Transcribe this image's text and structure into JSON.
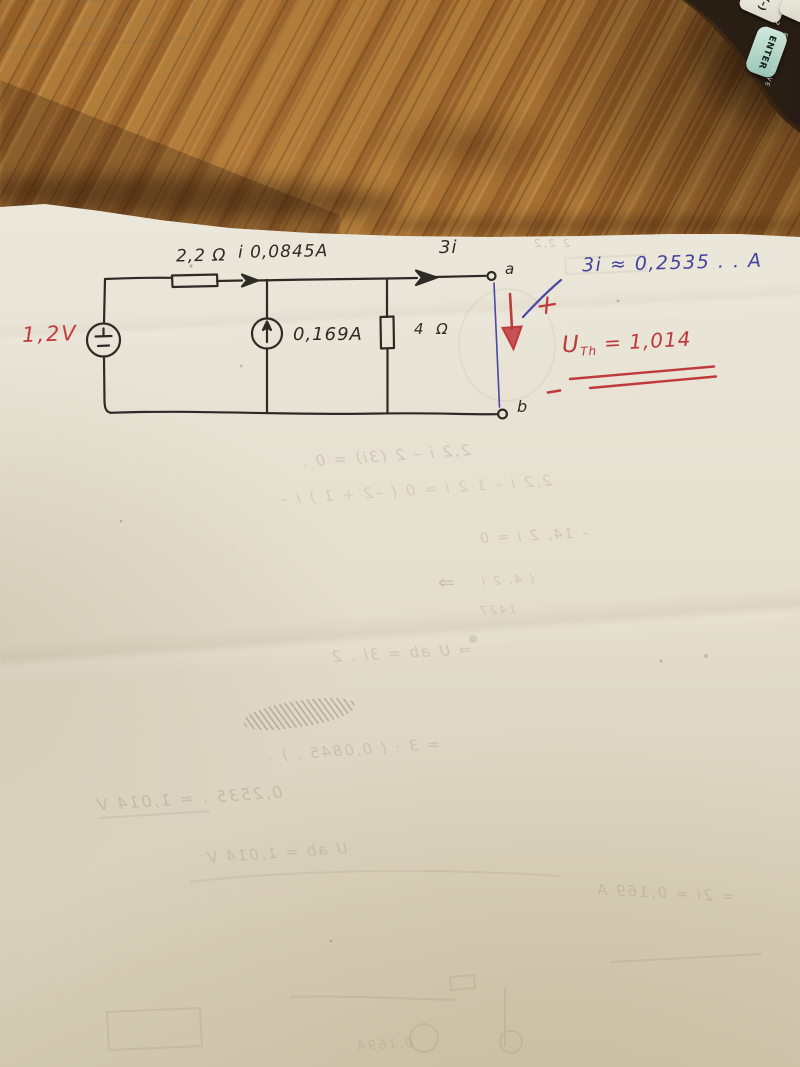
{
  "circuit": {
    "voltage_source_label": "1,2V",
    "top_resistor_label": "2,2 Ω",
    "current_label": "i 0,0845A",
    "dependent_source_label": "3i",
    "current_source_label": "0,169A",
    "right_resistor_label": "4 Ω",
    "terminal_a": "a",
    "terminal_b": "b"
  },
  "results": {
    "blue_note": "3i ≈ 0,2535 . . A",
    "uth_symbol": "U",
    "uth_subscript": "Th",
    "uth_value": " = 1,014"
  },
  "calculator": {
    "negate_key": "(–)",
    "enter_key": "ENTER",
    "body_print": "ENTRY SOLVE",
    "hint_mark": "?",
    "digit_mark": "3"
  },
  "bleedthrough": {
    "eq1": "2,2 i – 2 (3i) = 0 .",
    "eq2": "2,2 i – 1 2 i ≈ 0  ( –2 + 1 ) i –",
    "eq3": "– 14, 2 i = 0",
    "boxed_result": "i = 0,0845. .  A",
    "arrow": "⇒",
    "fraction_top": "( 4, 2 i",
    "fraction_bottom": "1427",
    "eq4": "⇒  U ab = 3i . 2",
    "eq5": "= 3 · ( 0,0845 . )  .",
    "eq6": "0,2535 .  ≈  1,014 V",
    "eq7": "U ab = 1,014 V",
    "eq8": "= 2i ≈ 0,169 A",
    "pencil_marks": "2 2,2",
    "circuit_label": "0,169A"
  },
  "colors": {
    "ink": "#2e2b26",
    "red_pen": "#c03a3c",
    "blue_pen": "#45439f",
    "paper": "#e9e5d8",
    "wood": "#96601f",
    "ghost": "#8a7f63",
    "enter_key": "#b2d6c8"
  }
}
